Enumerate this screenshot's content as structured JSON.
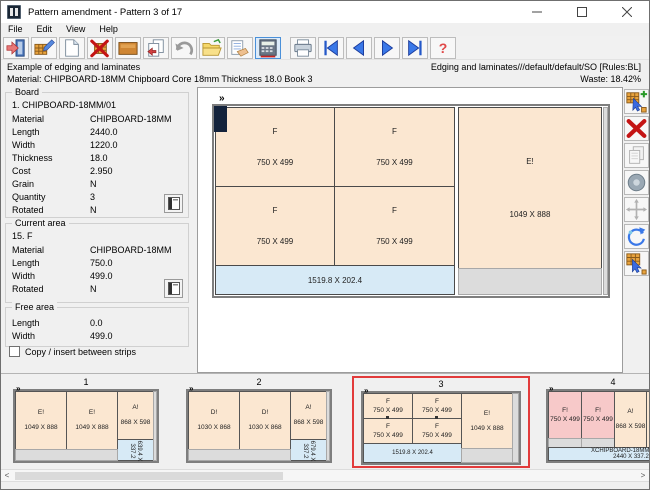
{
  "titlebar": {
    "title": "Pattern amendment - Pattern 3 of 17"
  },
  "menu": {
    "items": [
      "File",
      "Edit",
      "View",
      "Help"
    ]
  },
  "toolbar": {
    "help_glyph": "?"
  },
  "infobar": {
    "left_line1": "Example of edging and laminates",
    "left_line2": "Material: CHIPBOARD-18MM Chipboard Core 18mm Thickness  18.0 Book 3",
    "right_line1": "Edging and laminates///default/default/SO [Rules:BL]",
    "right_line2": "Waste: 18.42%"
  },
  "board": {
    "title": "Board",
    "heading": "1. CHIPBOARD-18MM/01",
    "rows": [
      {
        "label": "Material",
        "value": "CHIPBOARD-18MM"
      },
      {
        "label": "Length",
        "value": "2440.0"
      },
      {
        "label": "Width",
        "value": "1220.0"
      },
      {
        "label": "Thickness",
        "value": "18.0"
      },
      {
        "label": "Cost",
        "value": "2.950"
      },
      {
        "label": "Grain",
        "value": "N"
      },
      {
        "label": "Quantity",
        "value": "3"
      },
      {
        "label": "Rotated",
        "value": "N"
      }
    ]
  },
  "current_area": {
    "title": "Current area",
    "heading": "15. F",
    "rows": [
      {
        "label": "Material",
        "value": "CHIPBOARD-18MM"
      },
      {
        "label": "Length",
        "value": "750.0"
      },
      {
        "label": "Width",
        "value": "499.0"
      },
      {
        "label": "Rotated",
        "value": "N"
      }
    ]
  },
  "free_area": {
    "title": "Free area",
    "rows": [
      {
        "label": "Length",
        "value": "0.0"
      },
      {
        "label": "Width",
        "value": "499.0"
      }
    ]
  },
  "options": {
    "copy_insert_label": "Copy / insert between strips"
  },
  "pattern_view": {
    "marker": "»",
    "f1": {
      "label": "F",
      "size": "750 X 499"
    },
    "f2": {
      "label": "F",
      "size": "750 X 499"
    },
    "f3": {
      "label": "F",
      "size": "750 X 499"
    },
    "f4": {
      "label": "F",
      "size": "750 X 499"
    },
    "e": {
      "label": "E!",
      "size": "1049 X 888"
    },
    "offcut": "1519.8 X 202.4"
  },
  "thumbnails": {
    "t1": {
      "number": "1",
      "marker": "»",
      "p1": {
        "label": "E!",
        "size": "1049 X 888"
      },
      "p2": {
        "label": "E!",
        "size": "1049 X 888"
      },
      "p3": {
        "label": "A!",
        "size": "868 X 598"
      },
      "offcut": "639.4 X 337.2"
    },
    "t2": {
      "number": "2",
      "marker": "»",
      "p1": {
        "label": "D!",
        "size": "1030 X 868"
      },
      "p2": {
        "label": "D!",
        "size": "1030 X 868"
      },
      "p3": {
        "label": "A!",
        "size": "868 X 598"
      },
      "offcut": "679.4 X 337.2"
    },
    "t3": {
      "number": "3",
      "marker": "»",
      "f1": {
        "label": "F",
        "size": "750 X 499"
      },
      "f2": {
        "label": "F",
        "size": "750 X 499"
      },
      "f3": {
        "label": "F",
        "size": "750 X 499"
      },
      "f4": {
        "label": "F",
        "size": "750 X 499"
      },
      "e": {
        "label": "E!",
        "size": "1049 X 888"
      },
      "offcut": "1519.8 X 202.4"
    },
    "t4": {
      "number": "4",
      "marker": "»",
      "p1": {
        "label": "F!",
        "size": "750 X 499"
      },
      "p2": {
        "label": "F!",
        "size": "750 X 499"
      },
      "p3": {
        "label": "A!",
        "size": "868 X 598"
      },
      "p4": {
        "label": "A!",
        "size": "868 X 598"
      },
      "strip_line1": "XCHIPBOARD-18MM/000030",
      "strip_line2": "2440 X 337.2"
    }
  },
  "scrollbar": {
    "left_arrow": "<",
    "right_arrow": ">"
  }
}
